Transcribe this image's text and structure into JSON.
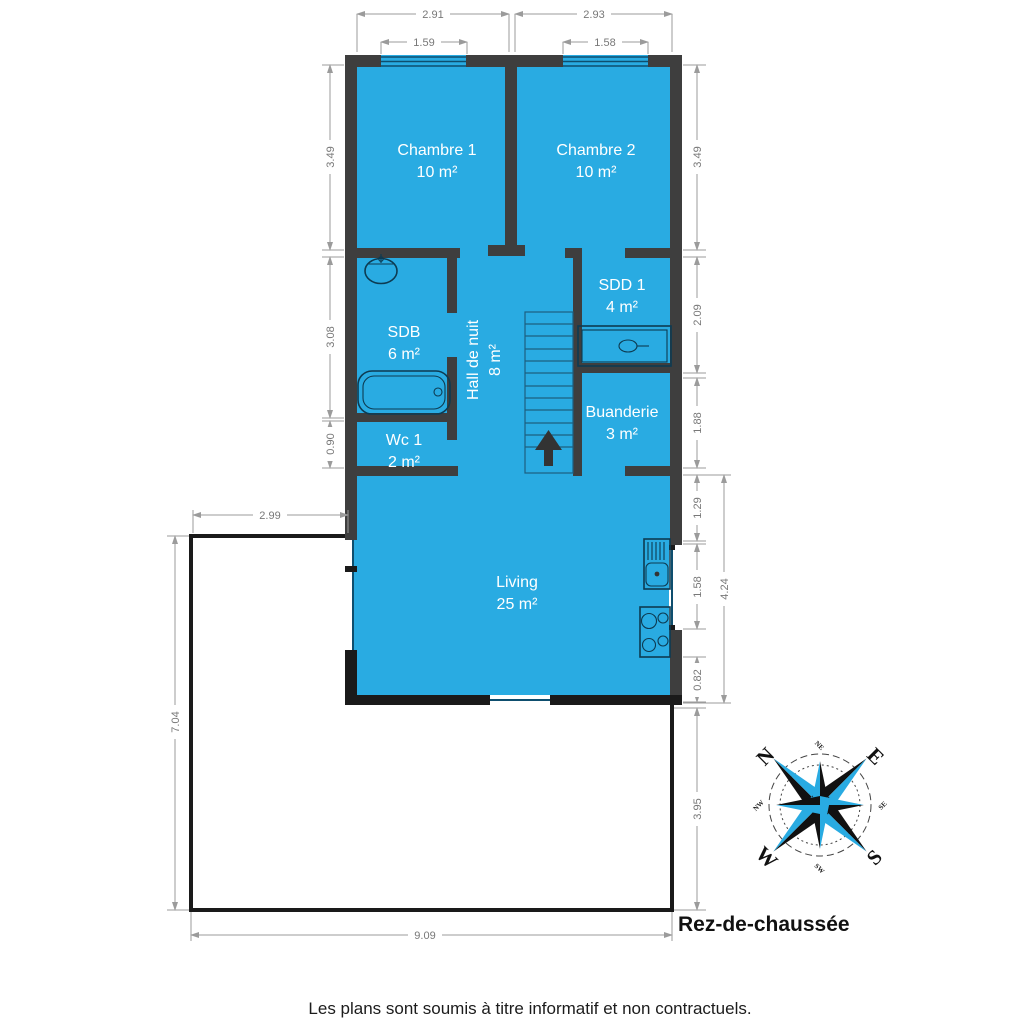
{
  "title": "Rez-de-chaussée",
  "disclaimer": "Les plans sont soumis à titre informatif et non contractuels.",
  "colors": {
    "floor_fill": "#29ABE2",
    "wall": "#3E3E3E",
    "terrace_outline": "#1A1A1A",
    "dimension_line": "#9B9B9B"
  },
  "rooms": [
    {
      "name": "Chambre 1",
      "area": "10 m²"
    },
    {
      "name": "Chambre 2",
      "area": "10 m²"
    },
    {
      "name": "SDB",
      "area": "6 m²"
    },
    {
      "name": "SDD 1",
      "area": "4 m²"
    },
    {
      "name": "Hall de nuit",
      "area": "8 m²"
    },
    {
      "name": "Buanderie",
      "area": "3 m²"
    },
    {
      "name": "Wc 1",
      "area": "2 m²"
    },
    {
      "name": "Living",
      "area": "25 m²"
    }
  ],
  "dims": {
    "top_left": "2.91",
    "top_right": "2.93",
    "window_left": "1.59",
    "window_right": "1.58",
    "left_1": "3.49",
    "left_2": "3.08",
    "left_3": "0.90",
    "right_1": "3.49",
    "right_2": "2.09",
    "right_3": "1.88",
    "right_4": "1.29",
    "right_5": "1.58",
    "right_6": "0.82",
    "right_total": "4.24",
    "right_7": "3.95",
    "terrace_top": "2.99",
    "terrace_left": "7.04",
    "bottom": "9.09"
  },
  "compass": {
    "n": "N",
    "e": "E",
    "s": "S",
    "w": "W",
    "ne": "NE",
    "se": "SE",
    "sw": "SW",
    "nw": "NW"
  }
}
